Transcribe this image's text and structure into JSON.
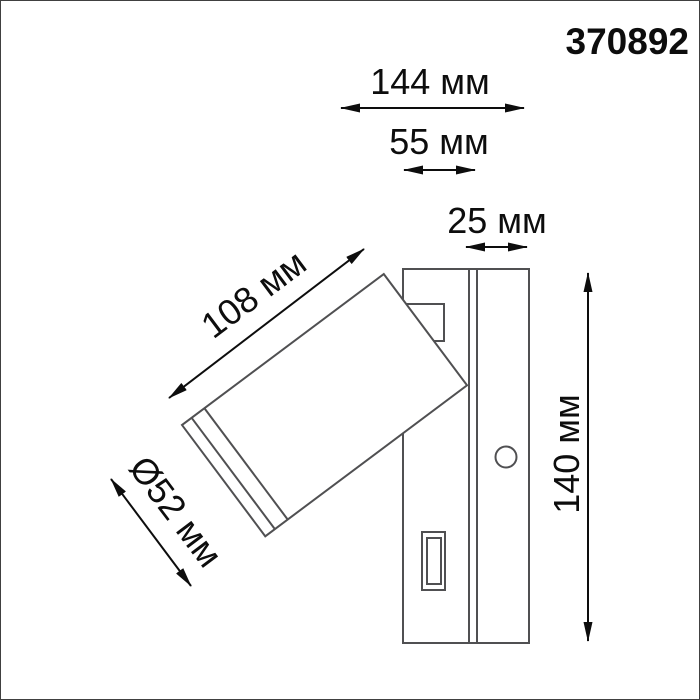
{
  "product": {
    "article": "370892"
  },
  "dimensions": {
    "total_width": "144 мм",
    "plate_body_width": "55 мм",
    "plate_depth": "25 мм",
    "spot_length": "108 мм",
    "spot_diameter": "Ø52 мм",
    "height": "140 мм"
  },
  "colors": {
    "background": "#ffffff",
    "drawing_line": "#505052",
    "dimension_line": "#0d0d0d",
    "text": "#0d0d0d",
    "frame": "#404040"
  }
}
